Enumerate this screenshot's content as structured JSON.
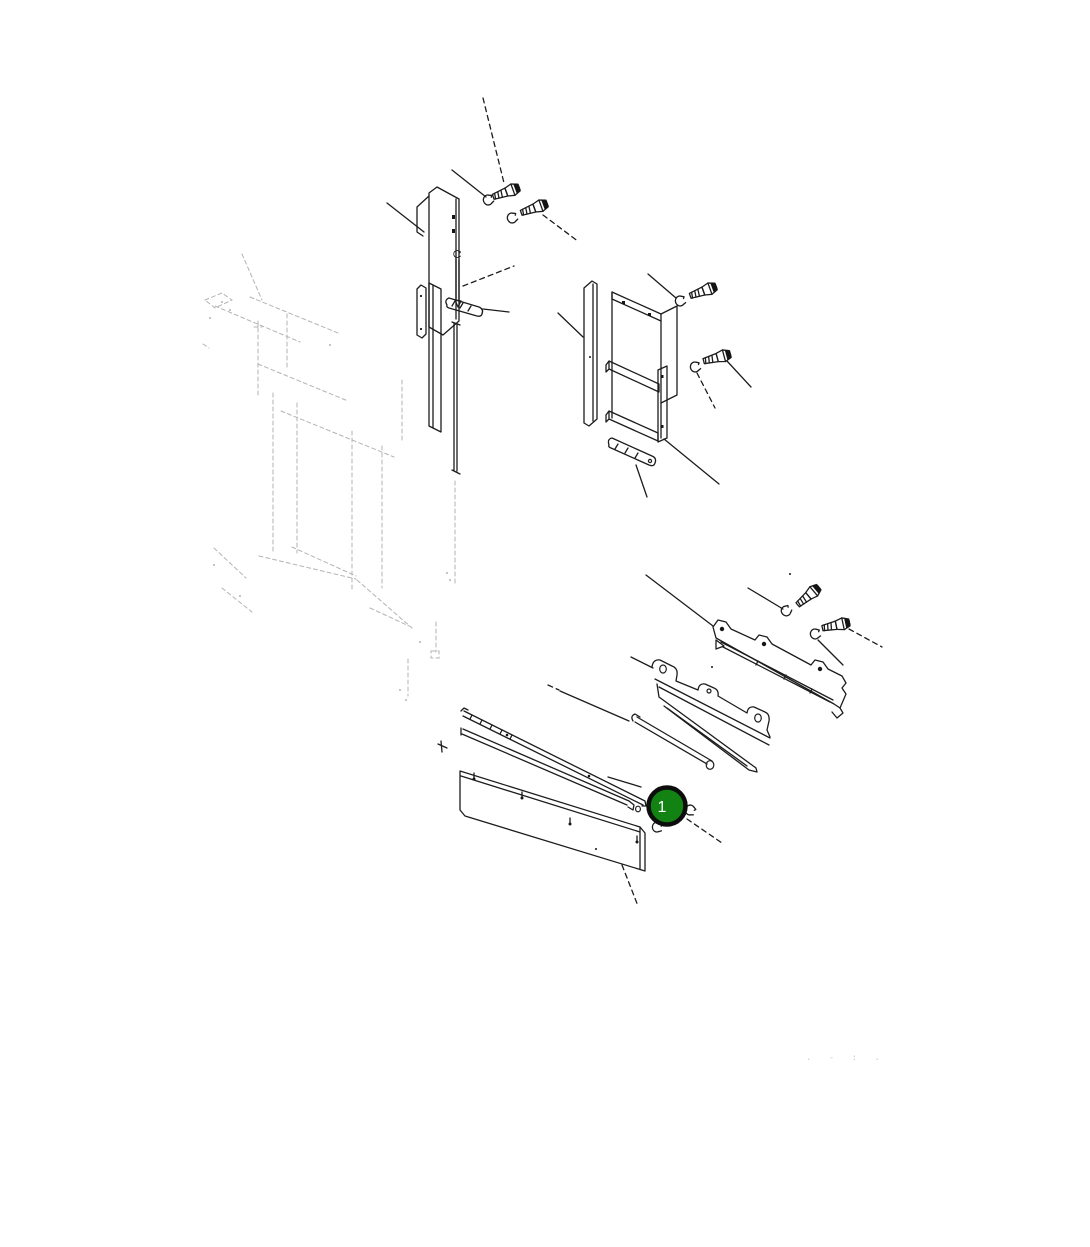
{
  "page": {
    "background": "#ffffff",
    "kind": "exploded-parts-diagram"
  },
  "diagram": {
    "line_color": "#1c1c1c",
    "phantom_color": "#b3b3b3"
  },
  "callout": {
    "label": "1",
    "fill": "#128212",
    "ring_color": "#0d0d0d",
    "label_color": "#ffffff"
  },
  "footer": {
    "marks": ". -  : ."
  }
}
